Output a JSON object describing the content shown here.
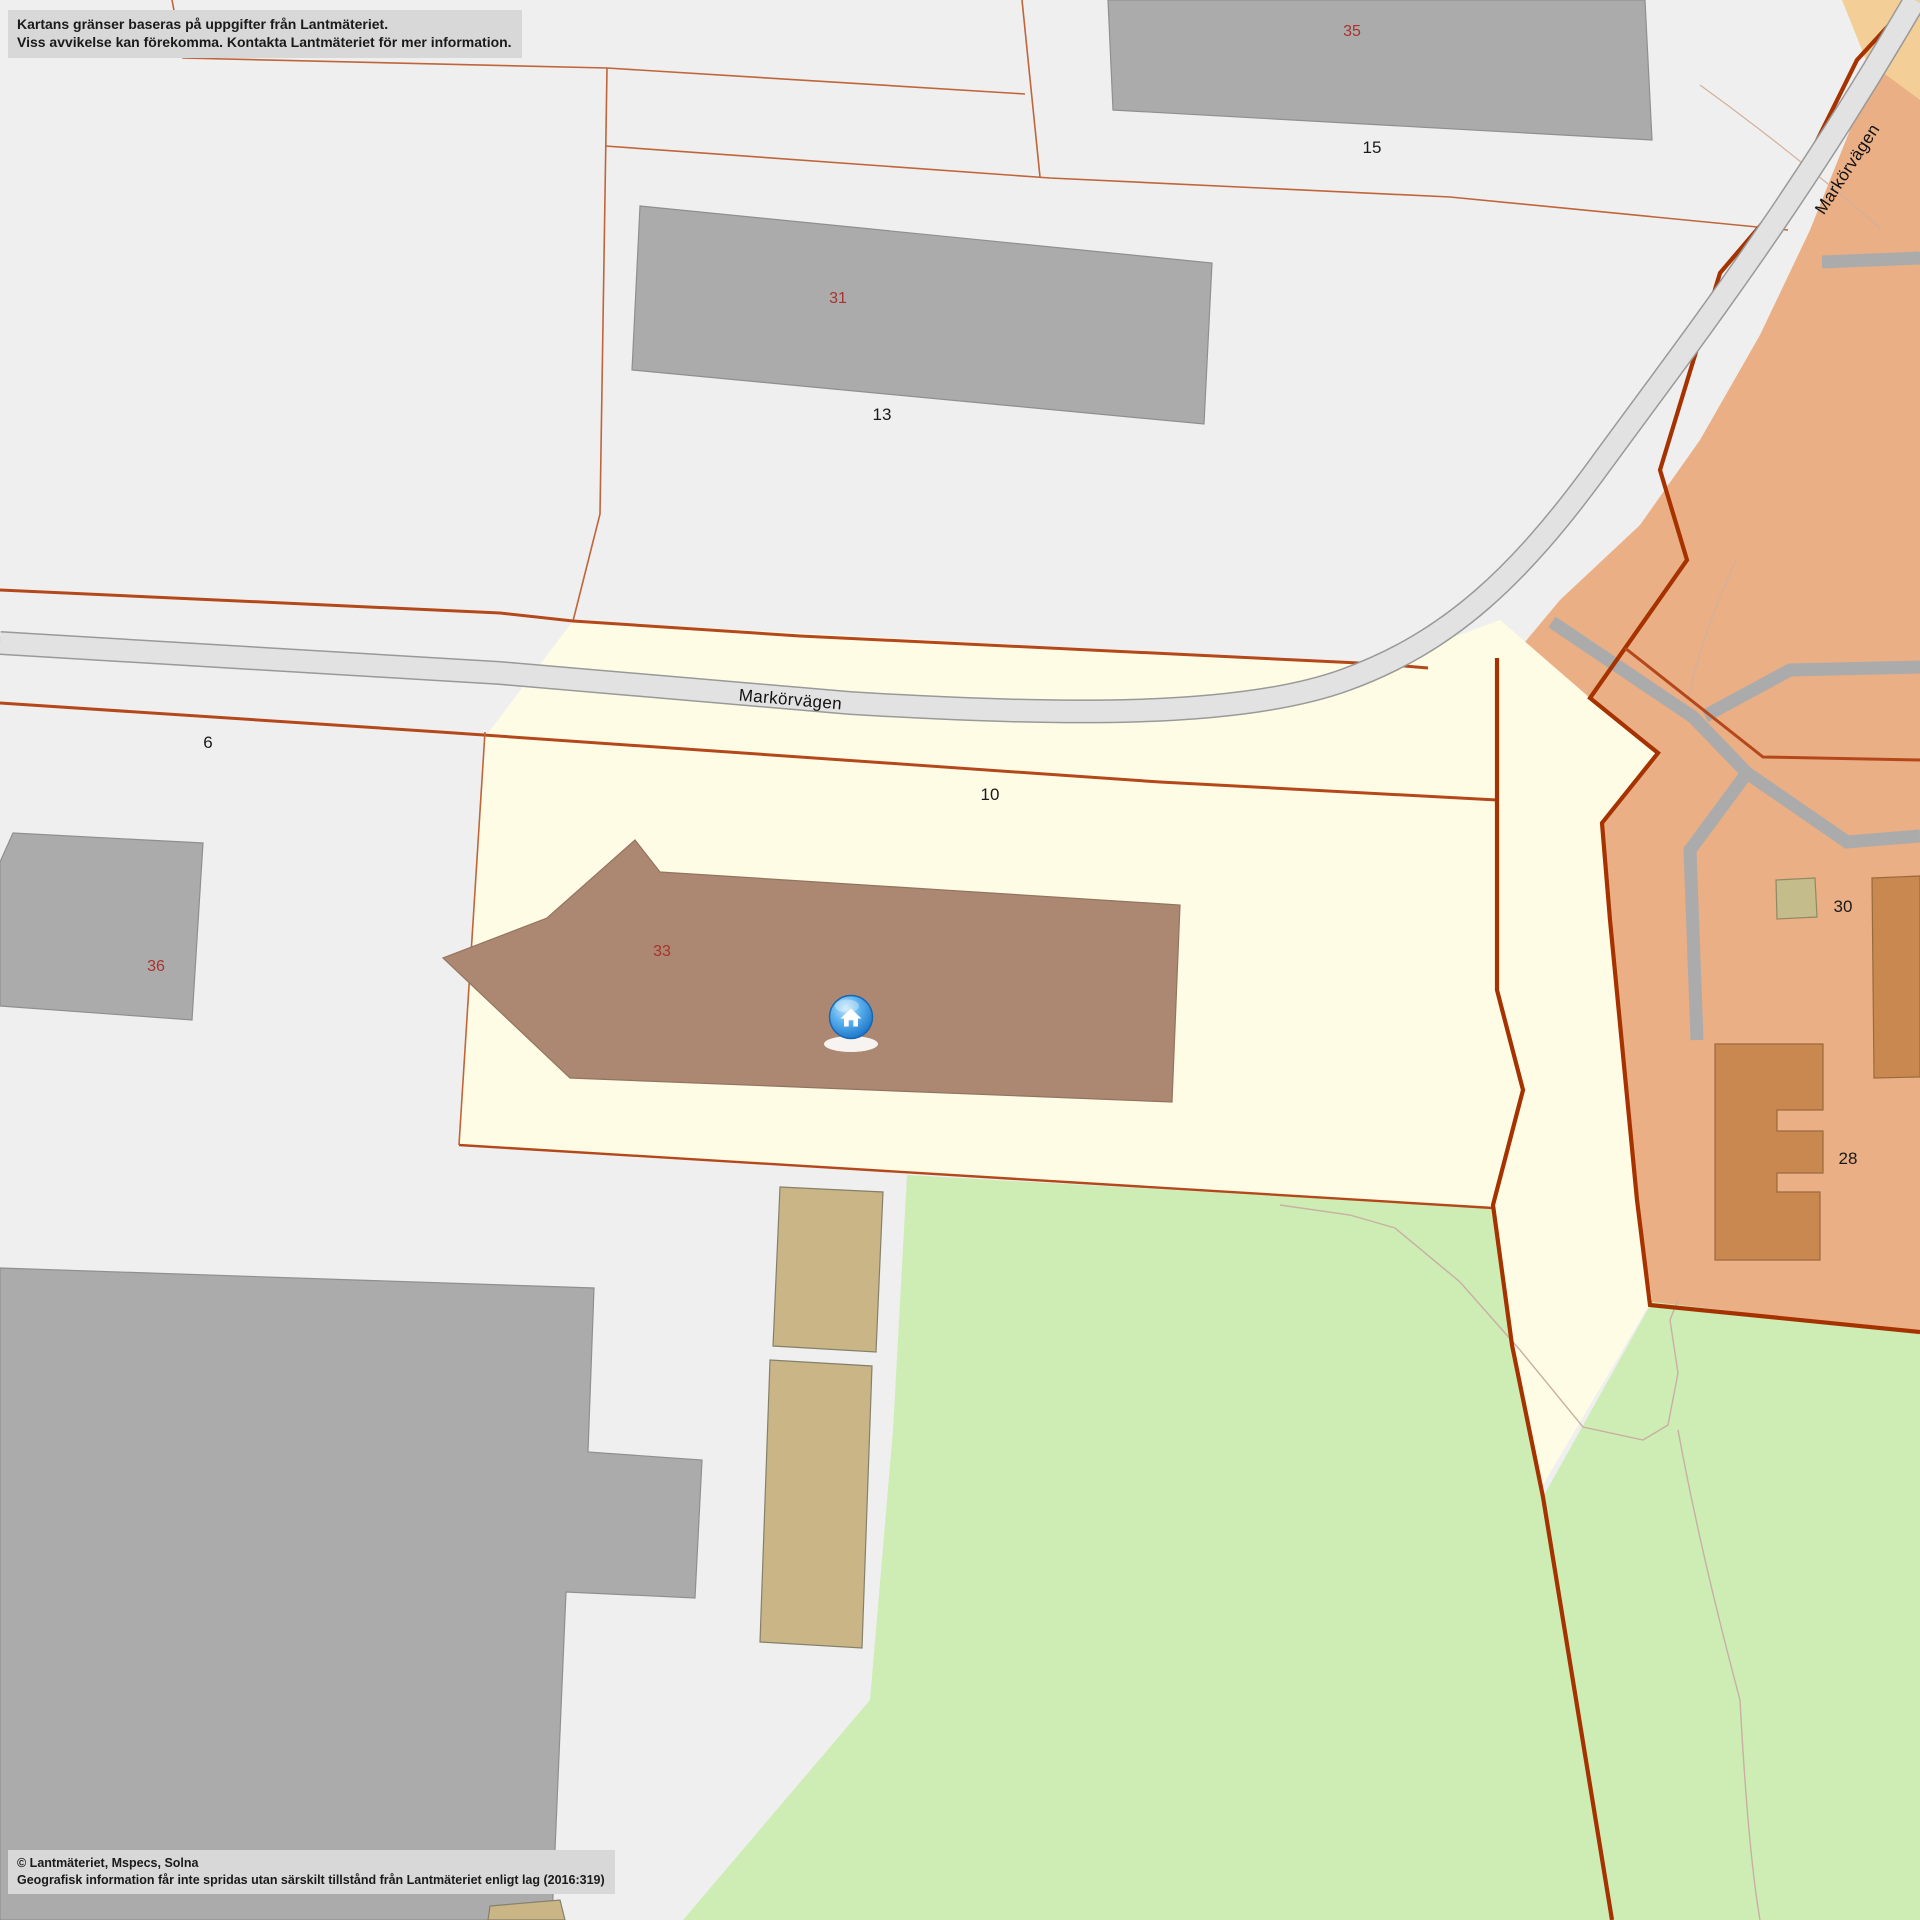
{
  "map": {
    "disclaimer": {
      "line1": "Kartans gränser baseras på uppgifter från Lantmäteriet.",
      "line2": "Viss avvikelse kan förekomma. Kontakta Lantmäteriet för mer information."
    },
    "copyright": {
      "line1": "© Lantmäteriet, Mspecs, Solna",
      "line2": "Geografisk information får inte spridas utan särskilt tillstånd från Lantmäteriet enligt lag (2016:319)"
    },
    "roads": {
      "main_label": "Markörvägen",
      "ne_label": "Markörvägen"
    },
    "labels": {
      "building_35": "35",
      "plot_15": "15",
      "building_31": "31",
      "plot_13": "13",
      "plot_6": "6",
      "plot_10": "10",
      "building_36": "36",
      "building_33": "33",
      "building_30": "30",
      "building_28": "28"
    },
    "marker": {
      "icon": "home-marker-icon"
    }
  },
  "colors": {
    "background": "#efefef",
    "road_fill": "#e2e2e2",
    "road_border": "#999999",
    "parcel_yellow": "#fffce6",
    "area_green": "#cdedb5",
    "zone_orange": "#ebaf85",
    "zone_tan": "#f3ce97",
    "building_gray": "#ababab",
    "building_brown": "#ac8772",
    "building_tan": "#c9b586",
    "building_khaki": "#c5bc8c",
    "building_orange": "#c8884f",
    "boundary_thin": "#c0653a",
    "boundary_medium": "#b4481a",
    "boundary_thick": "#a63200",
    "contour": "#c9afa4",
    "minor_road_gray": "#ababab",
    "label_red": "#a8332e",
    "label_black": "#1a1a1a",
    "marker_blue": "#2e8fd8",
    "infobox_bg": "#d8d8d8",
    "infobox_text": "#1a1a1a"
  }
}
